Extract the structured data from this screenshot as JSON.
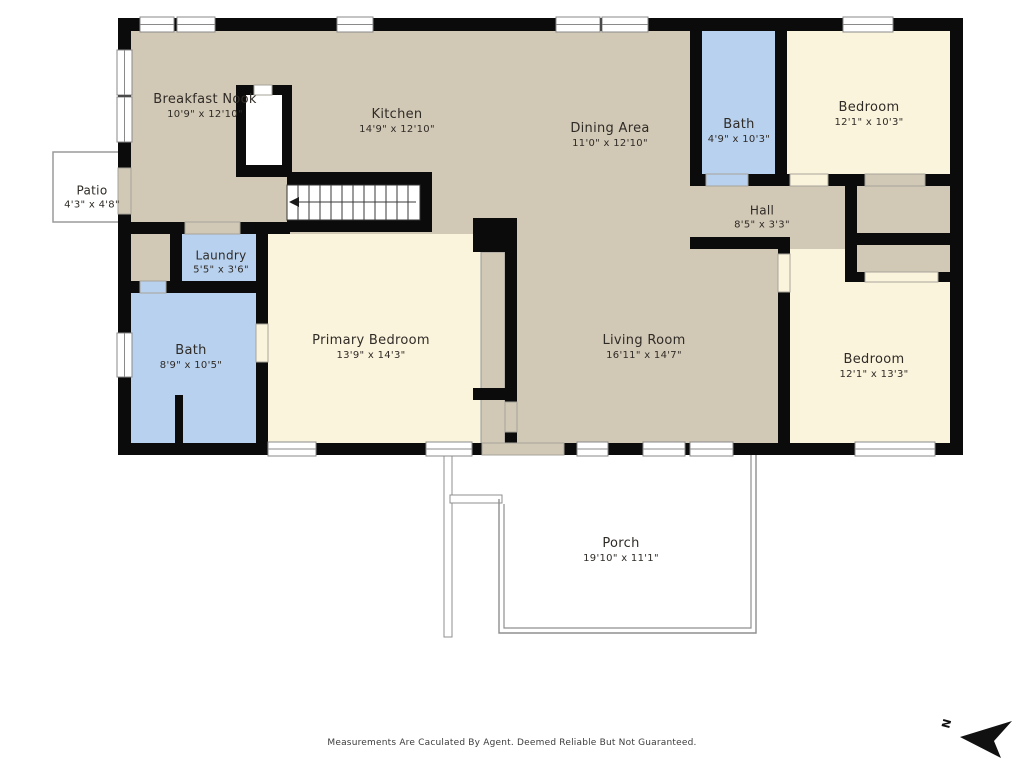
{
  "meta": {
    "disclaimer": "Measurements Are Caculated By Agent. Deemed Reliable But Not Guaranteed.",
    "north_label": "N"
  },
  "colors": {
    "tan": "#d2c8b6",
    "cream": "#fbf4dd",
    "blue": "#b8d1ef",
    "wall": "#0b0b0b",
    "sill": "#949494",
    "outline": "#8f8f8f"
  },
  "rooms": {
    "breakfast_nook": {
      "name": "Breakfast Nook",
      "dims": "10'9\" x 12'10\""
    },
    "kitchen": {
      "name": "Kitchen",
      "dims": "14'9\" x 12'10\""
    },
    "dining_area": {
      "name": "Dining Area",
      "dims": "11'0\" x 12'10\""
    },
    "bath_upper": {
      "name": "Bath",
      "dims": "4'9\" x 10'3\""
    },
    "bedroom_upper": {
      "name": "Bedroom",
      "dims": "12'1\" x 10'3\""
    },
    "hall": {
      "name": "Hall",
      "dims": "8'5\" x 3'3\""
    },
    "patio": {
      "name": "Patio",
      "dims": "4'3\" x 4'8\""
    },
    "laundry": {
      "name": "Laundry",
      "dims": "5'5\" x 3'6\""
    },
    "bath_left": {
      "name": "Bath",
      "dims": "8'9\" x 10'5\""
    },
    "primary_bedroom": {
      "name": "Primary Bedroom",
      "dims": "13'9\" x 14'3\""
    },
    "living_room": {
      "name": "Living Room",
      "dims": "16'11\" x 14'7\""
    },
    "bedroom_lower": {
      "name": "Bedroom",
      "dims": "12'1\" x 13'3\""
    },
    "porch": {
      "name": "Porch",
      "dims": "19'10\" x 11'1\""
    }
  }
}
